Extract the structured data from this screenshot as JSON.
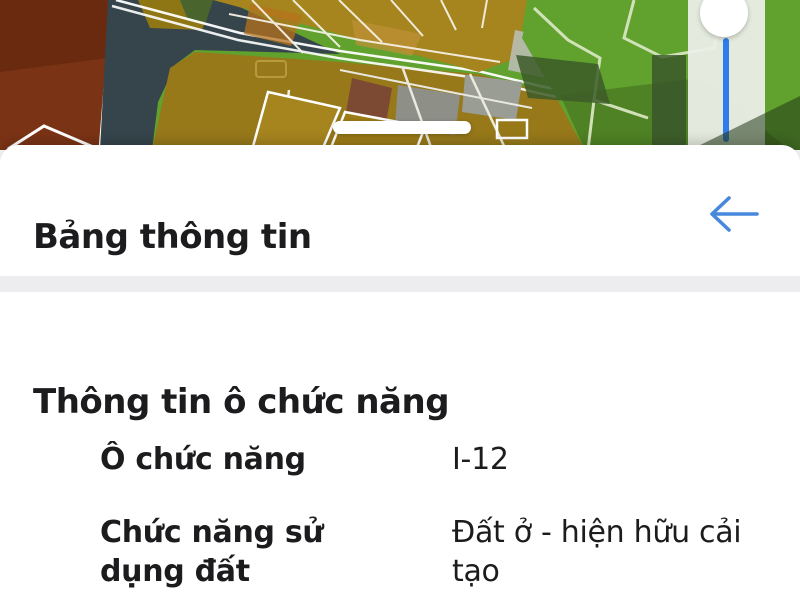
{
  "map": {
    "description": "satellite zoning map with colored land parcels",
    "zone_outline_color": "#e8491d",
    "parcel_colors": {
      "maroon": "#7a3315",
      "slate": "#35454b",
      "mustard": "#97791a",
      "gold_zone": "#a6841e",
      "green_field": "#61a12e"
    },
    "slider": {
      "track_color": "#2f7ced",
      "thumb_color": "#ffffff"
    }
  },
  "sheet": {
    "title": "Bảng thông tin",
    "back_icon": "arrow-left",
    "accent_color": "#4788dd",
    "section_heading": "Thông tin ô chức năng",
    "fields": [
      {
        "label": "Ô chức năng",
        "value": "I-12"
      },
      {
        "label": "Chức năng sử dụng đất",
        "value": "Đất ở - hiện hữu cải tạo"
      }
    ]
  }
}
